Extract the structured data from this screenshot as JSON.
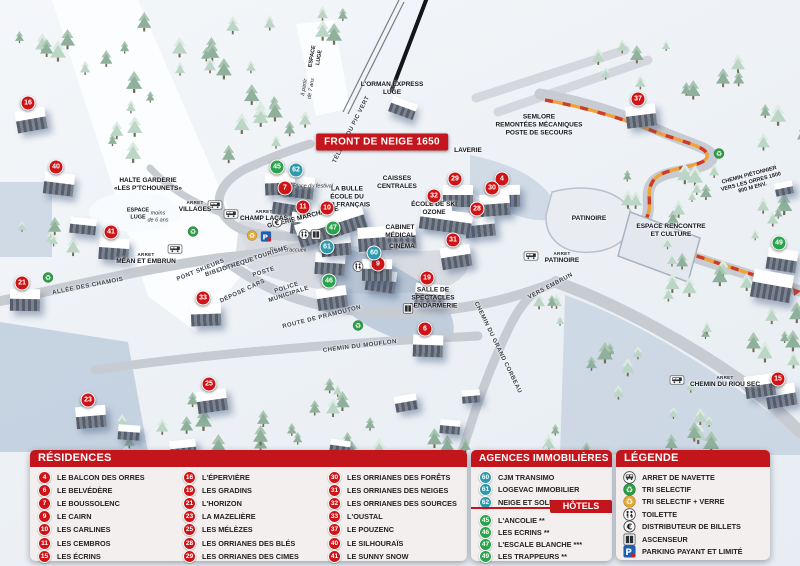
{
  "map": {
    "banner": "FRONT DE NEIGE 1650",
    "arret_label": "ARRET",
    "colors": {
      "residence_badge": "#cf1418",
      "agency_badge": "#2e9aab",
      "hotel_badge": "#2aa44c",
      "header_red": "#c3161c",
      "path_orange": "#f0a23a",
      "path_red_dash": "#cf3b2a"
    },
    "markers": [
      {
        "n": "16",
        "type": "res",
        "x": 28,
        "y": 103
      },
      {
        "n": "40",
        "type": "res",
        "x": 56,
        "y": 167
      },
      {
        "n": "41",
        "type": "res",
        "x": 111,
        "y": 232
      },
      {
        "n": "21",
        "type": "res",
        "x": 22,
        "y": 283
      },
      {
        "n": "33",
        "type": "res",
        "x": 203,
        "y": 298
      },
      {
        "n": "23",
        "type": "res",
        "x": 88,
        "y": 400
      },
      {
        "n": "25",
        "type": "res",
        "x": 209,
        "y": 384
      },
      {
        "n": "7",
        "type": "res",
        "x": 285,
        "y": 188
      },
      {
        "n": "11",
        "type": "res",
        "x": 303,
        "y": 207
      },
      {
        "n": "10",
        "type": "res",
        "x": 327,
        "y": 208
      },
      {
        "n": "29",
        "type": "res",
        "x": 455,
        "y": 179
      },
      {
        "n": "32",
        "type": "res",
        "x": 434,
        "y": 196
      },
      {
        "n": "28",
        "type": "res",
        "x": 477,
        "y": 209
      },
      {
        "n": "31",
        "type": "res",
        "x": 453,
        "y": 240
      },
      {
        "n": "9",
        "type": "res",
        "x": 378,
        "y": 264
      },
      {
        "n": "19",
        "type": "res",
        "x": 427,
        "y": 278
      },
      {
        "n": "6",
        "type": "res",
        "x": 425,
        "y": 329
      },
      {
        "n": "4",
        "type": "res",
        "x": 502,
        "y": 179
      },
      {
        "n": "30",
        "type": "res",
        "x": 492,
        "y": 188
      },
      {
        "n": "37",
        "type": "res",
        "x": 638,
        "y": 99
      },
      {
        "n": "15",
        "type": "res",
        "x": 778,
        "y": 379
      },
      {
        "n": "62",
        "type": "agency",
        "x": 296,
        "y": 170
      },
      {
        "n": "61",
        "type": "agency",
        "x": 327,
        "y": 247
      },
      {
        "n": "60",
        "type": "agency",
        "x": 374,
        "y": 253
      },
      {
        "n": "45",
        "type": "hotel",
        "x": 277,
        "y": 167
      },
      {
        "n": "47",
        "type": "hotel",
        "x": 333,
        "y": 228
      },
      {
        "n": "46",
        "type": "hotel",
        "x": 329,
        "y": 281
      },
      {
        "n": "49",
        "type": "hotel",
        "x": 779,
        "y": 243
      }
    ],
    "labels": [
      {
        "id": "espace-luge-7ans",
        "lines": [
          "ESPACE",
          "LUGE"
        ],
        "x": 316,
        "y": 57,
        "rot": -80,
        "cls": "l-tiny"
      },
      {
        "id": "a-partir-7ans",
        "lines": [
          "à partir",
          "de 7 ans"
        ],
        "x": 308,
        "y": 88,
        "rot": -80,
        "cls": "l-italic"
      },
      {
        "id": "teleski-pic-vert",
        "lines": [
          "TÉLÉSKI DU PIC VERT"
        ],
        "x": 352,
        "y": 130,
        "rot": -63,
        "cls": "l-road"
      },
      {
        "id": "orman-express",
        "lines": [
          "L'ORMAN EXPRESS",
          "LUGE"
        ],
        "x": 392,
        "y": 89,
        "rot": 0,
        "cls": ""
      },
      {
        "id": "semlore",
        "lines": [
          "SEMLORE",
          "REMONTÉES MÉCANIQUES",
          "POSTE DE SECOURS"
        ],
        "x": 539,
        "y": 125,
        "rot": 0,
        "cls": ""
      },
      {
        "id": "laverie",
        "lines": [
          "LAVERIE"
        ],
        "x": 468,
        "y": 151,
        "rot": 0,
        "cls": ""
      },
      {
        "id": "caisses-centrales",
        "lines": [
          "CAISSES",
          "CENTRALES"
        ],
        "x": 397,
        "y": 183,
        "rot": 0,
        "cls": ""
      },
      {
        "id": "ecole-ski-ozone",
        "lines": [
          "ÉCOLE DE SKI",
          "OZONE"
        ],
        "x": 434,
        "y": 209,
        "rot": 0,
        "cls": ""
      },
      {
        "id": "la-bulle-esf",
        "lines": [
          "LA BULLE",
          "ÉCOLE DU",
          "SKI FRANÇAIS"
        ],
        "x": 347,
        "y": 197,
        "rot": 0,
        "cls": ""
      },
      {
        "id": "galerie-marchande",
        "lines": [
          "GALERIE MARCHANDE"
        ],
        "x": 303,
        "y": 218,
        "rot": -14,
        "cls": ""
      },
      {
        "id": "cabinet-medical",
        "lines": [
          "CABINET",
          "MÉDICAL"
        ],
        "x": 400,
        "y": 232,
        "rot": 0,
        "cls": ""
      },
      {
        "id": "cinema",
        "lines": [
          "CINÉMA"
        ],
        "x": 402,
        "y": 247,
        "rot": 0,
        "cls": ""
      },
      {
        "id": "place-du-festival",
        "lines": [
          "Place du festival"
        ],
        "x": 313,
        "y": 187,
        "rot": 0,
        "cls": "l-italic"
      },
      {
        "id": "place-d-accueil",
        "lines": [
          "Place d'accueil"
        ],
        "x": 288,
        "y": 251,
        "rot": 0,
        "cls": "l-italic"
      },
      {
        "id": "office-de-tourisme",
        "lines": [
          "OFFICE DE TOURISME"
        ],
        "x": 253,
        "y": 260,
        "rot": -18,
        "cls": "l-road"
      },
      {
        "id": "bibliotheque",
        "lines": [
          "BIBLIOTHÈQUE"
        ],
        "x": 230,
        "y": 268,
        "rot": -18,
        "cls": "l-road"
      },
      {
        "id": "poste",
        "lines": [
          "POSTE"
        ],
        "x": 264,
        "y": 273,
        "rot": -18,
        "cls": "l-road"
      },
      {
        "id": "depose-cars",
        "lines": [
          "DÉPOSE CARS"
        ],
        "x": 243,
        "y": 292,
        "rot": -25,
        "cls": "l-road"
      },
      {
        "id": "police-municipale",
        "lines": [
          "POLICE",
          "MUNICIPALE"
        ],
        "x": 288,
        "y": 292,
        "rot": -18,
        "cls": "l-road"
      },
      {
        "id": "halte-garderie",
        "lines": [
          "HALTE GARDERIE",
          "«LES P'TCHOUNETS»"
        ],
        "x": 148,
        "y": 185,
        "rot": 0,
        "cls": ""
      },
      {
        "id": "espace-luge-6ans",
        "lines": [
          "ESPACE",
          "LUGE"
        ],
        "x": 138,
        "y": 214,
        "rot": 0,
        "cls": "l-tiny"
      },
      {
        "id": "moins-de-6-ans",
        "lines": [
          "moins",
          "de 6 ans"
        ],
        "x": 158,
        "y": 217,
        "rot": 0,
        "cls": "l-italic"
      },
      {
        "id": "allee-des-chamois",
        "lines": [
          "ALLÉE DES CHAMOIS"
        ],
        "x": 88,
        "y": 287,
        "rot": -11,
        "cls": "l-road"
      },
      {
        "id": "pont-skieurs",
        "lines": [
          "PONT SKIEURS"
        ],
        "x": 201,
        "y": 271,
        "rot": -22,
        "cls": "l-road"
      },
      {
        "id": "route-de-pramouton",
        "lines": [
          "ROUTE DE PRAMOUTON"
        ],
        "x": 322,
        "y": 318,
        "rot": -14,
        "cls": "l-road"
      },
      {
        "id": "chemin-du-mouflon",
        "lines": [
          "CHEMIN DU MOUFLON"
        ],
        "x": 360,
        "y": 347,
        "rot": -7,
        "cls": "l-road"
      },
      {
        "id": "chemin-du-grand-corbeau",
        "lines": [
          "CHEMIN DU GRAND CORBEAU"
        ],
        "x": 497,
        "y": 348,
        "rot": 64,
        "cls": "l-road"
      },
      {
        "id": "salle-de-spectacles",
        "lines": [
          "SALLE DE",
          "SPECTACLES",
          "GENDARMERIE"
        ],
        "x": 433,
        "y": 298,
        "rot": 0,
        "cls": ""
      },
      {
        "id": "vers-embrun",
        "lines": [
          "VERS EMBRUN"
        ],
        "x": 551,
        "y": 287,
        "rot": -28,
        "cls": "l-road"
      },
      {
        "id": "patinoire",
        "lines": [
          "PATINOIRE"
        ],
        "x": 589,
        "y": 219,
        "rot": 0,
        "cls": ""
      },
      {
        "id": "espace-rencontre-et-culture",
        "lines": [
          "ESPACE RENCONTRE",
          "ET CULTURE"
        ],
        "x": 671,
        "y": 231,
        "rot": 0,
        "cls": ""
      },
      {
        "id": "chemin-pietonnier-1800",
        "lines": [
          "CHEMIN PIÉTONNIER",
          "VERS LES ORRES 1800",
          "800 M ENV."
        ],
        "x": 751,
        "y": 182,
        "rot": -15,
        "cls": "l-tiny"
      }
    ],
    "bus_stops": [
      {
        "name": "VILLAGES",
        "ix": 215,
        "iy": 206,
        "tx": 195,
        "ty": 207
      },
      {
        "name": "CHAMP LACAS",
        "ix": 231,
        "iy": 215,
        "tx": 264,
        "ty": 216
      },
      {
        "name": "MÉAN ET EMBRUN",
        "ix": 175,
        "iy": 250,
        "tx": 146,
        "ty": 259
      },
      {
        "name": "PATINOIRE",
        "ix": 531,
        "iy": 257,
        "tx": 562,
        "ty": 258
      },
      {
        "name": "CHEMIN DU RIOU SEC",
        "ix": 677,
        "iy": 381,
        "tx": 725,
        "ty": 382
      }
    ],
    "icons": [
      {
        "type": "recycle-green-icon",
        "x": 193,
        "y": 233
      },
      {
        "type": "recycle-green-icon",
        "x": 48,
        "y": 279
      },
      {
        "type": "recycle-green-icon",
        "x": 358,
        "y": 327
      },
      {
        "type": "recycle-green-icon",
        "x": 719,
        "y": 155
      },
      {
        "type": "recycle-yellow-icon",
        "x": 252,
        "y": 237
      },
      {
        "type": "parking-icon",
        "x": 266,
        "y": 238
      },
      {
        "type": "euro-icon",
        "x": 277,
        "y": 224
      },
      {
        "type": "wc-icon",
        "x": 304,
        "y": 236
      },
      {
        "type": "elevator-icon",
        "x": 316,
        "y": 236
      },
      {
        "type": "wc-icon",
        "x": 358,
        "y": 268
      },
      {
        "type": "elevator-icon",
        "x": 408,
        "y": 310
      }
    ]
  },
  "panels": {
    "residences": {
      "title": "RÉSIDENCES",
      "items": [
        {
          "n": "4",
          "name": "LE BALCON DES ORRES"
        },
        {
          "n": "6",
          "name": "LE BELVÉDÈRE"
        },
        {
          "n": "7",
          "name": "LE BOUSSOLENC"
        },
        {
          "n": "9",
          "name": "LE CAIRN"
        },
        {
          "n": "10",
          "name": "LES CARLINES"
        },
        {
          "n": "11",
          "name": "LES CEMBROS"
        },
        {
          "n": "15",
          "name": "LES ÉCRINS"
        },
        {
          "n": "16",
          "name": "L'ÉPERVIÈRE"
        },
        {
          "n": "19",
          "name": "LES GRADINS"
        },
        {
          "n": "21",
          "name": "L'HORIZON"
        },
        {
          "n": "23",
          "name": "LA MAZELIÈRE"
        },
        {
          "n": "25",
          "name": "LES MÉLÈZES"
        },
        {
          "n": "28",
          "name": "LES ORRIANES DES BLÉS"
        },
        {
          "n": "29",
          "name": "LES ORRIANES DES CIMES"
        },
        {
          "n": "30",
          "name": "LES ORRIANES DES FORÊTS"
        },
        {
          "n": "31",
          "name": "LES ORRIANES DES NEIGES"
        },
        {
          "n": "32",
          "name": "LES ORRIANES DES SOURCES"
        },
        {
          "n": "33",
          "name": "L'OUSTAL"
        },
        {
          "n": "37",
          "name": "LE POUZENC"
        },
        {
          "n": "40",
          "name": "LE SILHOURAÏS"
        },
        {
          "n": "41",
          "name": "LE SUNNY SNOW"
        }
      ]
    },
    "agences": {
      "title": "AGENCES IMMOBILIÈRES",
      "items": [
        {
          "n": "60",
          "name": "CJM TRANSIMO"
        },
        {
          "n": "61",
          "name": "LOGEVAC IMMOBILIER"
        },
        {
          "n": "62",
          "name": "NEIGE ET SOLEIL"
        }
      ]
    },
    "hotels": {
      "title": "HÔTELS",
      "items": [
        {
          "n": "45",
          "name": "L'ANCOLIE **"
        },
        {
          "n": "46",
          "name": "LES ECRINS **"
        },
        {
          "n": "47",
          "name": "L'ESCALE BLANCHE ***"
        },
        {
          "n": "49",
          "name": "LES TRAPPEURS **"
        }
      ]
    },
    "legende": {
      "title": "LÉGENDE",
      "items": [
        {
          "icon": "bus-icon",
          "label": "ARRET DE NAVETTE"
        },
        {
          "icon": "recycle-green-icon",
          "label": "TRI SELECTIF"
        },
        {
          "icon": "recycle-yellow-icon",
          "label": "TRI SELECTIF + VERRE"
        },
        {
          "icon": "wc-icon",
          "label": "TOILETTE"
        },
        {
          "icon": "euro-icon",
          "label": "DISTRIBUTEUR DE BILLETS"
        },
        {
          "icon": "elevator-icon",
          "label": "ASCENSEUR"
        },
        {
          "icon": "parking-icon",
          "label": "PARKING PAYANT ET LIMITÉ"
        }
      ]
    }
  }
}
